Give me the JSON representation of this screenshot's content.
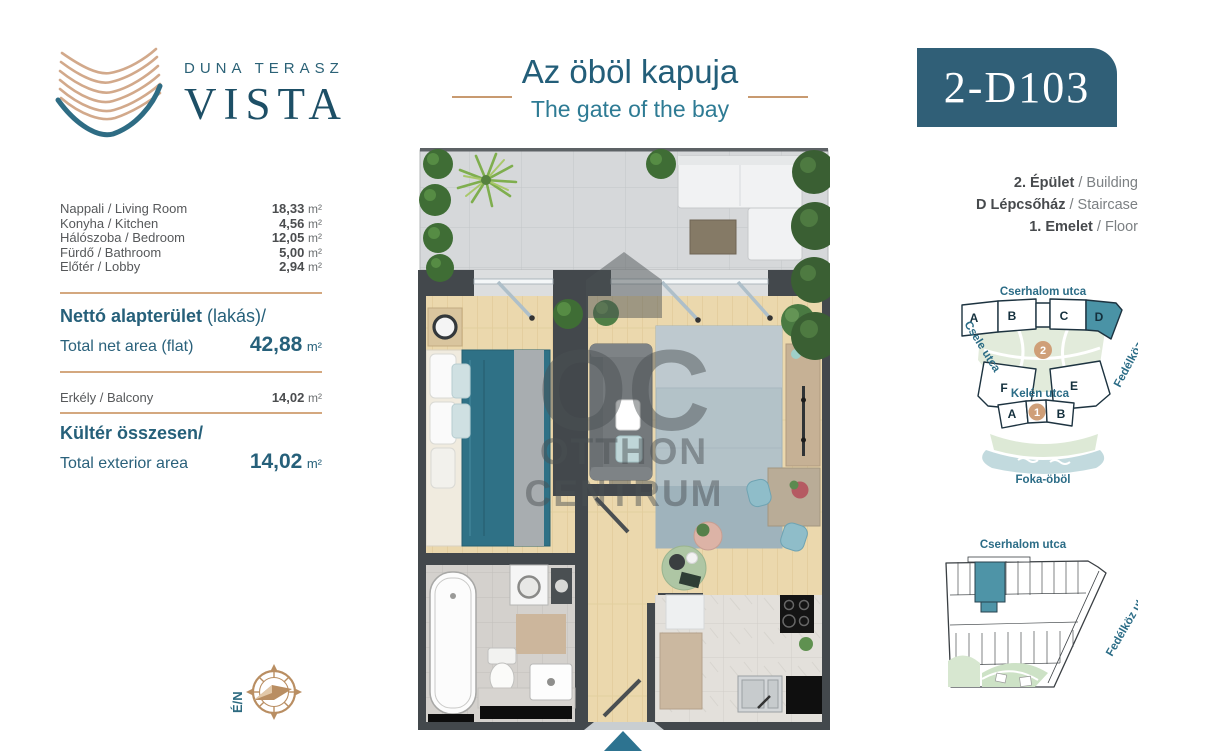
{
  "header": {
    "brand_line1": "DUNA TERASZ",
    "brand_line2": "VISTA",
    "title_hu": "Az öböl kapuja",
    "title_en": "The gate of the bay",
    "unit_code": "2-D103"
  },
  "areas": {
    "rooms": [
      {
        "label": "Nappali / Living Room",
        "value": "18,33",
        "unit": "m²"
      },
      {
        "label": "Konyha / Kitchen",
        "value": "4,56",
        "unit": "m²"
      },
      {
        "label": "Hálószoba / Bedroom",
        "value": "12,05",
        "unit": "m²"
      },
      {
        "label": "Fürdő / Bathroom",
        "value": "5,00",
        "unit": "m²"
      },
      {
        "label": "Előtér / Lobby",
        "value": "2,94",
        "unit": "m²"
      }
    ],
    "net_title_bold": "Nettó alapterület",
    "net_title_rest": " (lakás)/",
    "net_label_en": "Total net area (flat)",
    "net_value": "42,88",
    "net_unit": "m²",
    "balcony_label": "Erkély / Balcony",
    "balcony_value": "14,02",
    "balcony_unit": "m²",
    "exterior_title": "Kültér összesen/",
    "exterior_label_en": "Total exterior area",
    "exterior_value": "14,02",
    "exterior_unit": "m²"
  },
  "location": {
    "building_bold": "2. Épület",
    "building_rest": " / Building",
    "staircase_bold": "D Lépcsőház",
    "staircase_rest": " / Staircase",
    "floor_bold": "1. Emelet",
    "floor_rest": " / Floor"
  },
  "site_map": {
    "street_top": "Cserhalom utca",
    "street_left": "Csele utca",
    "street_right": "Fedélköz utca",
    "street_mid": "Kelén utca",
    "bay_label": "Foka-öböl",
    "upper_blocks": [
      "A",
      "B",
      "C",
      "D"
    ],
    "mid_blocks": [
      "F",
      "E"
    ],
    "lower_blocks": [
      "A",
      "B"
    ],
    "phase_upper": "2",
    "phase_lower": "1",
    "highlighted_block": "D"
  },
  "floor_map": {
    "street_top": "Cserhalom utca",
    "street_right": "Fedélköz utca"
  },
  "compass": {
    "north_label": "É/N"
  },
  "watermark": {
    "monogram": "OC",
    "line1": "OTTHON",
    "line2": "CENTRUM"
  },
  "colors": {
    "teal_text": "#2b6277",
    "tan_accent": "#c89a70",
    "badge_bg": "#305f77",
    "highlight_unit": "#4a93a6",
    "wall": "#43484c",
    "wood": "#ebd8ad"
  }
}
